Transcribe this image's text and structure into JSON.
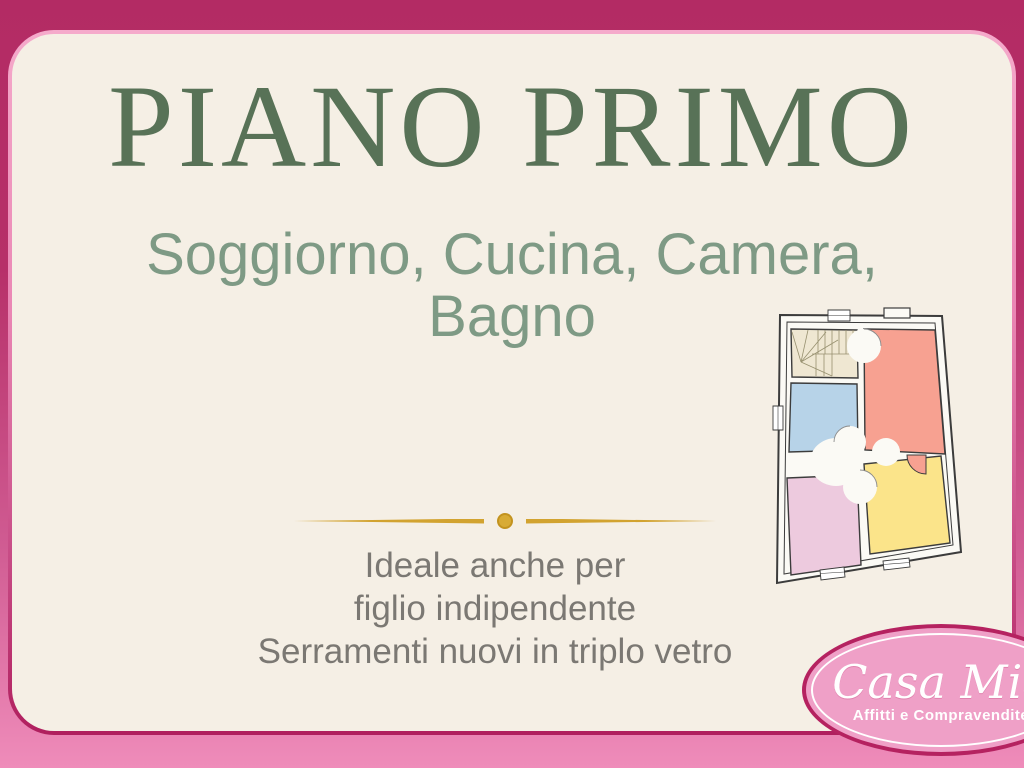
{
  "slide": {
    "title": "PIANO PRIMO",
    "subtitle": {
      "line1": "Soggiorno, Cucina, Camera,",
      "line2": "Bagno"
    },
    "notes": {
      "line1": "Ideale anche per",
      "line2": "figlio indipendente",
      "line3": "Serramenti nuovi in triplo vetro"
    }
  },
  "logo": {
    "brand": "Casa Mia",
    "tagline": "Affitti e Compravendite"
  },
  "colors": {
    "frame_top_magenta": "#b32b64",
    "frame_bottom_pink": "#ef8cba",
    "frame_ring_light": "#f5aacb",
    "frame_ring_dark": "#b01f5e",
    "panel_cream": "#f5efe5",
    "title_green": "#587257",
    "subtitle_green": "#7e9a85",
    "notes_gray": "#7b7873",
    "divider_gold": "#d2a330",
    "logo_pink": "#efa0c7",
    "logo_border": "#b52260",
    "floorplan_wall": "#3c3c3c",
    "floorplan_room_salmon": "#f7a191",
    "floorplan_room_blue": "#b7d3e8",
    "floorplan_room_lilac": "#edcade",
    "floorplan_room_yellow": "#fbe48a",
    "floorplan_stairs_beige": "#efe7d2"
  }
}
